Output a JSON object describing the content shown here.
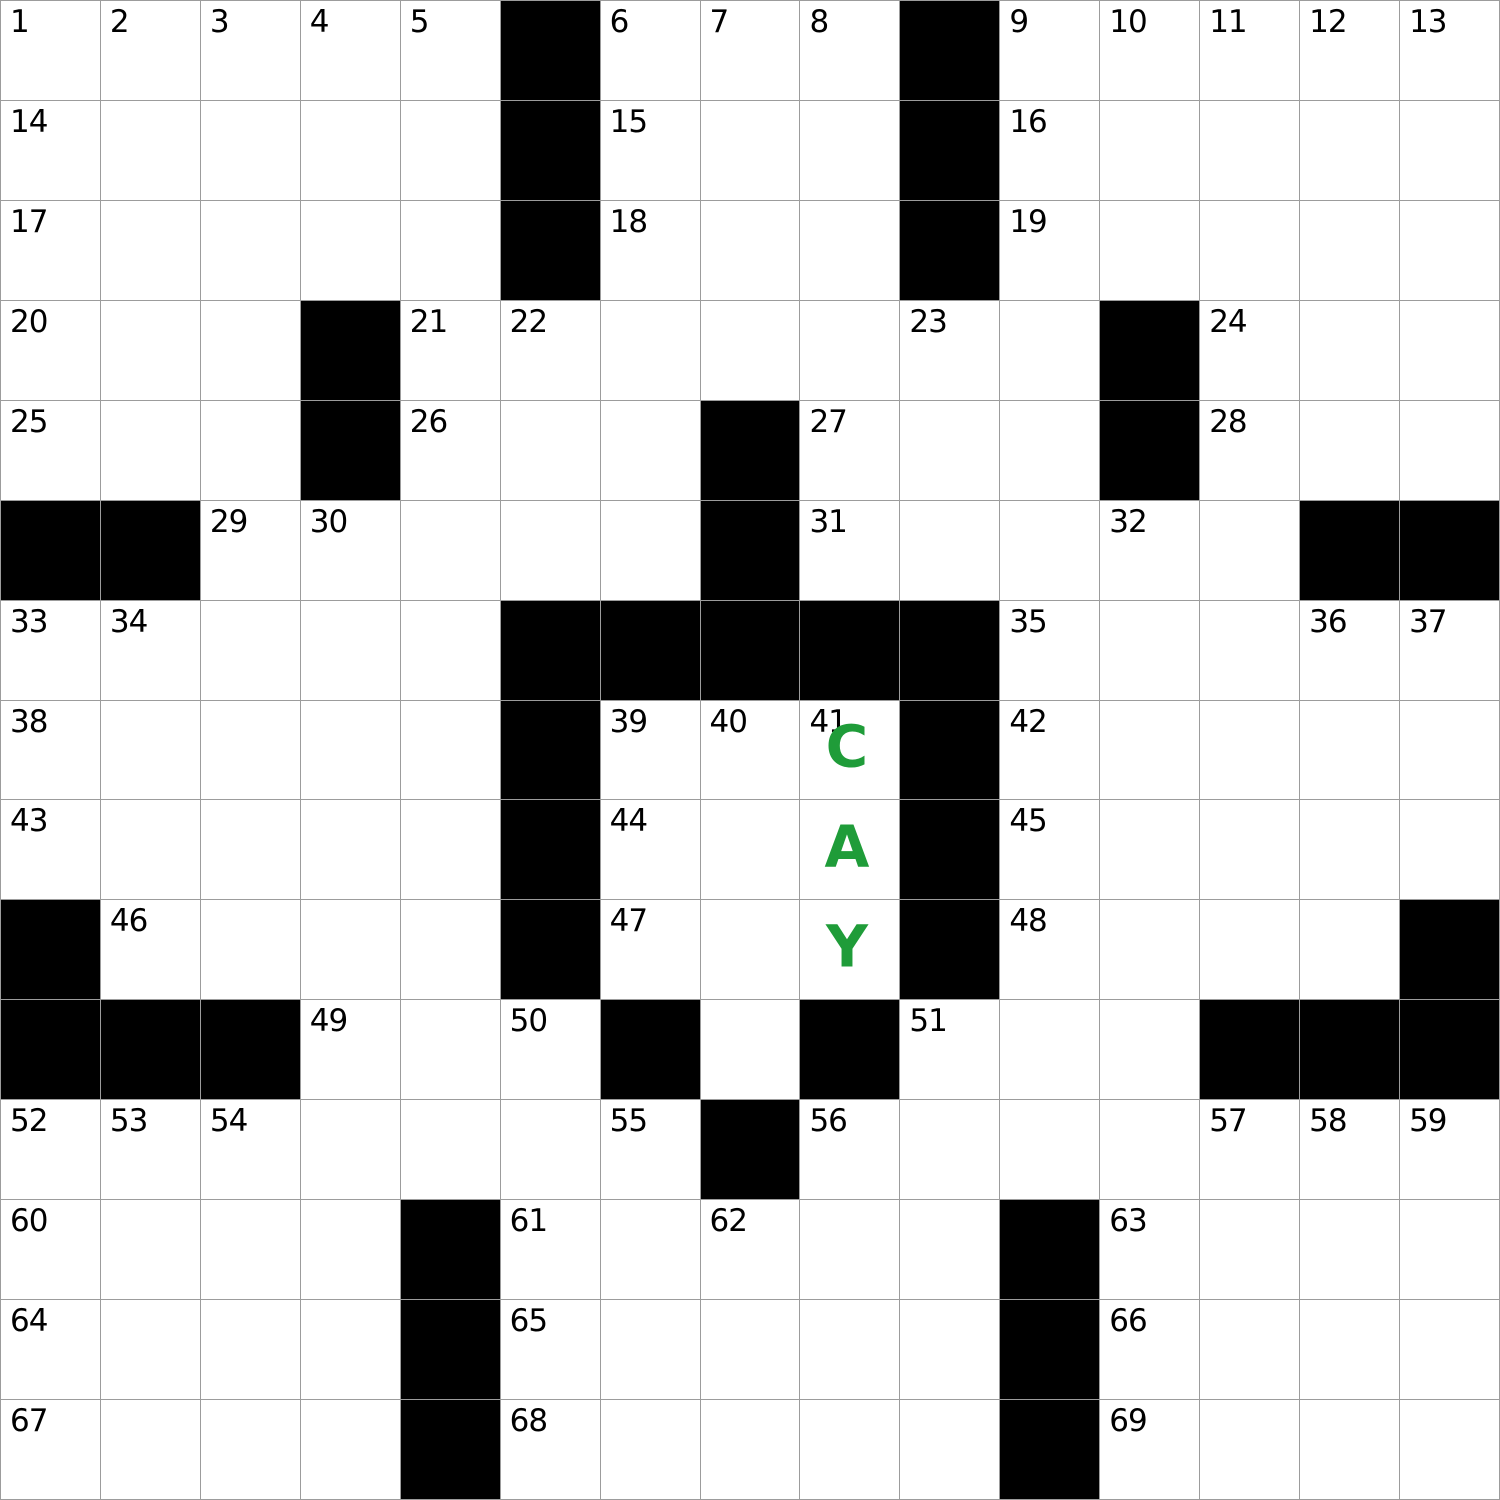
{
  "puzzle": {
    "kind": "crossword-grid",
    "grid": {
      "rows": 15,
      "cols": 15,
      "cell_size_px": 100,
      "colors": {
        "cell_background": "#ffffff",
        "black_cell": "#000000",
        "grid_line": "#9c9c9c",
        "number_text": "#000000",
        "entry_letter_text": "#1f9c39"
      },
      "black_cells": [
        [
          0,
          5
        ],
        [
          0,
          9
        ],
        [
          1,
          5
        ],
        [
          1,
          9
        ],
        [
          2,
          5
        ],
        [
          2,
          9
        ],
        [
          3,
          3
        ],
        [
          3,
          11
        ],
        [
          4,
          3
        ],
        [
          4,
          7
        ],
        [
          4,
          11
        ],
        [
          5,
          0
        ],
        [
          5,
          1
        ],
        [
          5,
          7
        ],
        [
          5,
          13
        ],
        [
          5,
          14
        ],
        [
          6,
          5
        ],
        [
          6,
          6
        ],
        [
          6,
          7
        ],
        [
          6,
          8
        ],
        [
          6,
          9
        ],
        [
          7,
          5
        ],
        [
          7,
          9
        ],
        [
          8,
          5
        ],
        [
          8,
          9
        ],
        [
          9,
          0
        ],
        [
          9,
          5
        ],
        [
          9,
          9
        ],
        [
          9,
          14
        ],
        [
          10,
          0
        ],
        [
          10,
          1
        ],
        [
          10,
          2
        ],
        [
          10,
          6
        ],
        [
          10,
          8
        ],
        [
          10,
          12
        ],
        [
          10,
          13
        ],
        [
          10,
          14
        ],
        [
          11,
          7
        ],
        [
          12,
          4
        ],
        [
          12,
          10
        ],
        [
          13,
          4
        ],
        [
          13,
          10
        ],
        [
          14,
          4
        ],
        [
          14,
          10
        ]
      ],
      "numbers": [
        {
          "num": "1",
          "row": 0,
          "col": 0
        },
        {
          "num": "2",
          "row": 0,
          "col": 1
        },
        {
          "num": "3",
          "row": 0,
          "col": 2
        },
        {
          "num": "4",
          "row": 0,
          "col": 3
        },
        {
          "num": "5",
          "row": 0,
          "col": 4
        },
        {
          "num": "6",
          "row": 0,
          "col": 6
        },
        {
          "num": "7",
          "row": 0,
          "col": 7
        },
        {
          "num": "8",
          "row": 0,
          "col": 8
        },
        {
          "num": "9",
          "row": 0,
          "col": 10
        },
        {
          "num": "10",
          "row": 0,
          "col": 11
        },
        {
          "num": "11",
          "row": 0,
          "col": 12
        },
        {
          "num": "12",
          "row": 0,
          "col": 13
        },
        {
          "num": "13",
          "row": 0,
          "col": 14
        },
        {
          "num": "14",
          "row": 1,
          "col": 0
        },
        {
          "num": "15",
          "row": 1,
          "col": 6
        },
        {
          "num": "16",
          "row": 1,
          "col": 10
        },
        {
          "num": "17",
          "row": 2,
          "col": 0
        },
        {
          "num": "18",
          "row": 2,
          "col": 6
        },
        {
          "num": "19",
          "row": 2,
          "col": 10
        },
        {
          "num": "20",
          "row": 3,
          "col": 0
        },
        {
          "num": "21",
          "row": 3,
          "col": 4
        },
        {
          "num": "22",
          "row": 3,
          "col": 5
        },
        {
          "num": "23",
          "row": 3,
          "col": 9
        },
        {
          "num": "24",
          "row": 3,
          "col": 12
        },
        {
          "num": "25",
          "row": 4,
          "col": 0
        },
        {
          "num": "26",
          "row": 4,
          "col": 4
        },
        {
          "num": "27",
          "row": 4,
          "col": 8
        },
        {
          "num": "28",
          "row": 4,
          "col": 12
        },
        {
          "num": "29",
          "row": 5,
          "col": 2
        },
        {
          "num": "30",
          "row": 5,
          "col": 3
        },
        {
          "num": "31",
          "row": 5,
          "col": 8
        },
        {
          "num": "32",
          "row": 5,
          "col": 11
        },
        {
          "num": "33",
          "row": 6,
          "col": 0
        },
        {
          "num": "34",
          "row": 6,
          "col": 1
        },
        {
          "num": "35",
          "row": 6,
          "col": 10
        },
        {
          "num": "36",
          "row": 6,
          "col": 13
        },
        {
          "num": "37",
          "row": 6,
          "col": 14
        },
        {
          "num": "38",
          "row": 7,
          "col": 0
        },
        {
          "num": "39",
          "row": 7,
          "col": 6
        },
        {
          "num": "40",
          "row": 7,
          "col": 7
        },
        {
          "num": "41",
          "row": 7,
          "col": 8
        },
        {
          "num": "42",
          "row": 7,
          "col": 10
        },
        {
          "num": "43",
          "row": 8,
          "col": 0
        },
        {
          "num": "44",
          "row": 8,
          "col": 6
        },
        {
          "num": "45",
          "row": 8,
          "col": 10
        },
        {
          "num": "46",
          "row": 9,
          "col": 1
        },
        {
          "num": "47",
          "row": 9,
          "col": 6
        },
        {
          "num": "48",
          "row": 9,
          "col": 10
        },
        {
          "num": "49",
          "row": 10,
          "col": 3
        },
        {
          "num": "50",
          "row": 10,
          "col": 5
        },
        {
          "num": "51",
          "row": 10,
          "col": 9
        },
        {
          "num": "52",
          "row": 11,
          "col": 0
        },
        {
          "num": "53",
          "row": 11,
          "col": 1
        },
        {
          "num": "54",
          "row": 11,
          "col": 2
        },
        {
          "num": "55",
          "row": 11,
          "col": 6
        },
        {
          "num": "56",
          "row": 11,
          "col": 8
        },
        {
          "num": "57",
          "row": 11,
          "col": 12
        },
        {
          "num": "58",
          "row": 11,
          "col": 13
        },
        {
          "num": "59",
          "row": 11,
          "col": 14
        },
        {
          "num": "60",
          "row": 12,
          "col": 0
        },
        {
          "num": "61",
          "row": 12,
          "col": 5
        },
        {
          "num": "62",
          "row": 12,
          "col": 7
        },
        {
          "num": "63",
          "row": 12,
          "col": 11
        },
        {
          "num": "64",
          "row": 13,
          "col": 0
        },
        {
          "num": "65",
          "row": 13,
          "col": 5
        },
        {
          "num": "66",
          "row": 13,
          "col": 11
        },
        {
          "num": "67",
          "row": 14,
          "col": 0
        },
        {
          "num": "68",
          "row": 14,
          "col": 5
        },
        {
          "num": "69",
          "row": 14,
          "col": 11
        }
      ],
      "entries": [
        {
          "letter": "C",
          "row": 7,
          "col": 8
        },
        {
          "letter": "A",
          "row": 8,
          "col": 8
        },
        {
          "letter": "Y",
          "row": 9,
          "col": 8
        }
      ]
    }
  }
}
